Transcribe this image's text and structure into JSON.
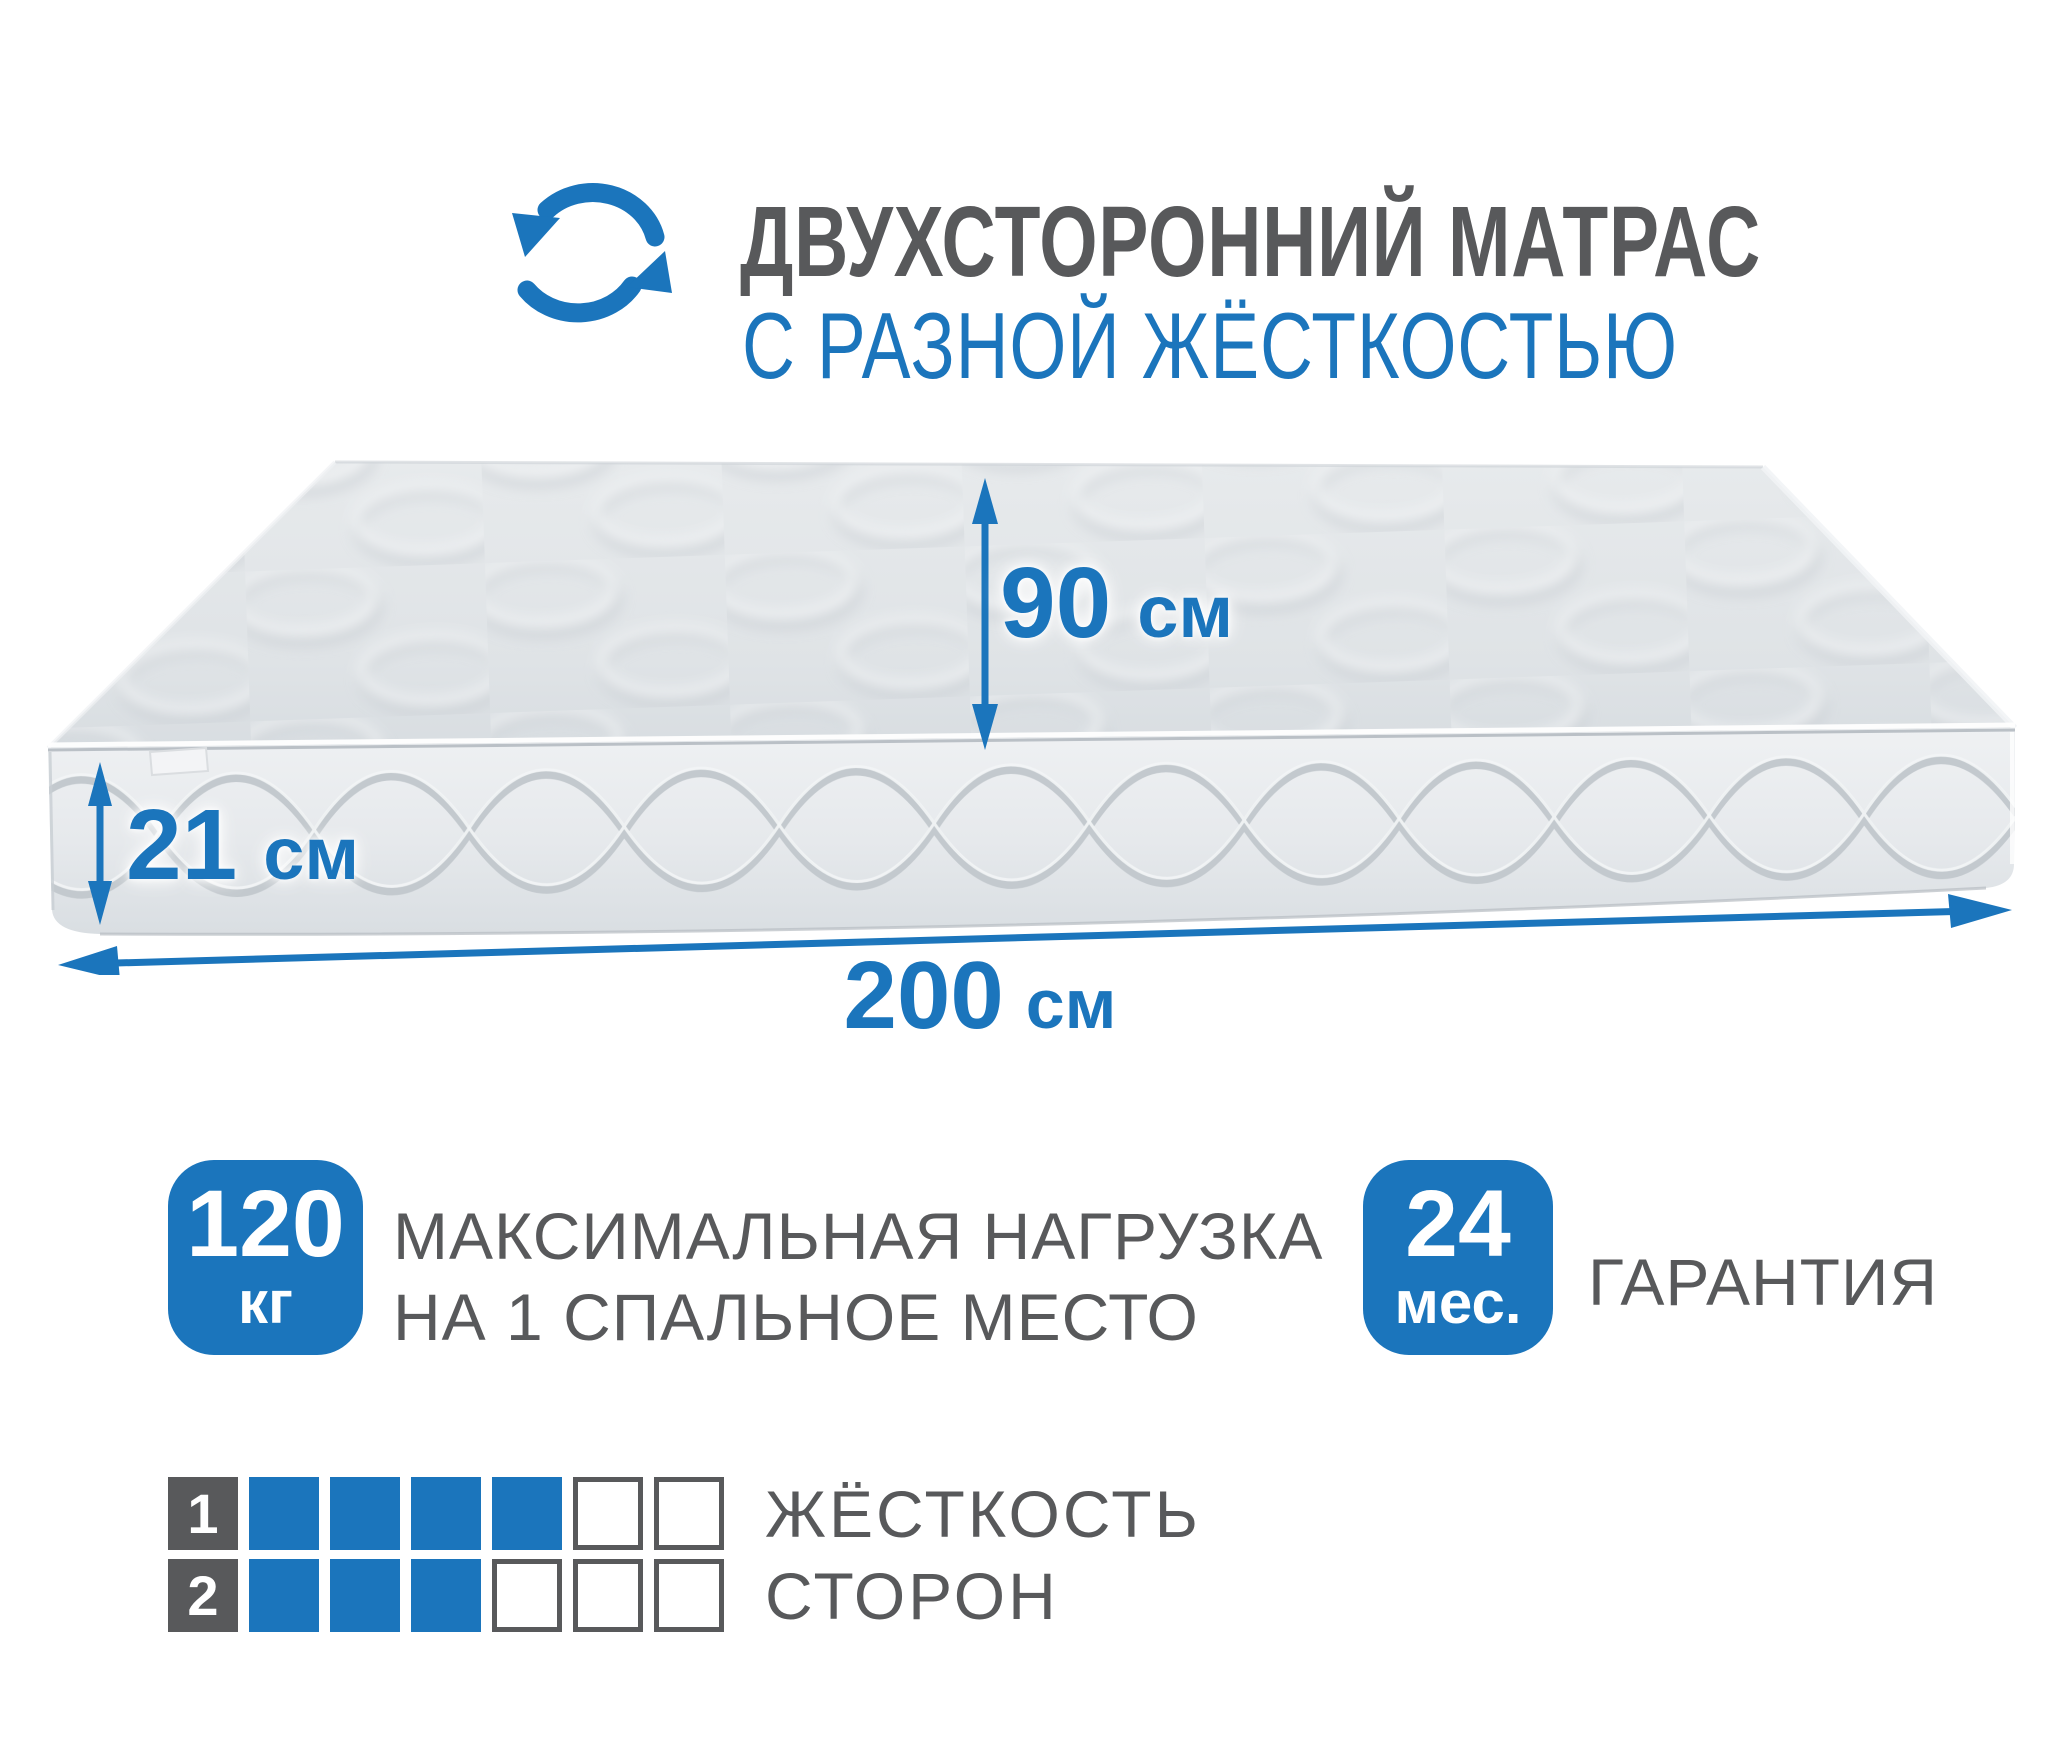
{
  "colors": {
    "accent_blue": "#1b75bc",
    "text_gray": "#58595b",
    "mattress_light": "#e9eced",
    "mattress_shadow": "#c6cbd0"
  },
  "header": {
    "title": "ДВУХСТОРОННИЙ МАТРАС",
    "subtitle": "С РАЗНОЙ ЖЁСТКОСТЬЮ"
  },
  "mattress": {
    "dimensions": {
      "width": {
        "value": "90",
        "unit": "см"
      },
      "height": {
        "value": "21",
        "unit": "см"
      },
      "length": {
        "value": "200",
        "unit": "см"
      }
    }
  },
  "features": {
    "max_load": {
      "badge_value": "120",
      "badge_unit": "кг",
      "label_line1": "МАКСИМАЛЬНАЯ НАГРУЗКА",
      "label_line2": "НА 1 СПАЛЬНОЕ МЕСТО"
    },
    "warranty": {
      "badge_value": "24",
      "badge_unit": "мес.",
      "label": "ГАРАНТИЯ"
    }
  },
  "firmness": {
    "title_line1": "ЖЁСТКОСТЬ",
    "title_line2": "СТОРОН",
    "scale_cells": 6,
    "sides": [
      {
        "label": "1",
        "filled": 4
      },
      {
        "label": "2",
        "filled": 3
      }
    ]
  }
}
